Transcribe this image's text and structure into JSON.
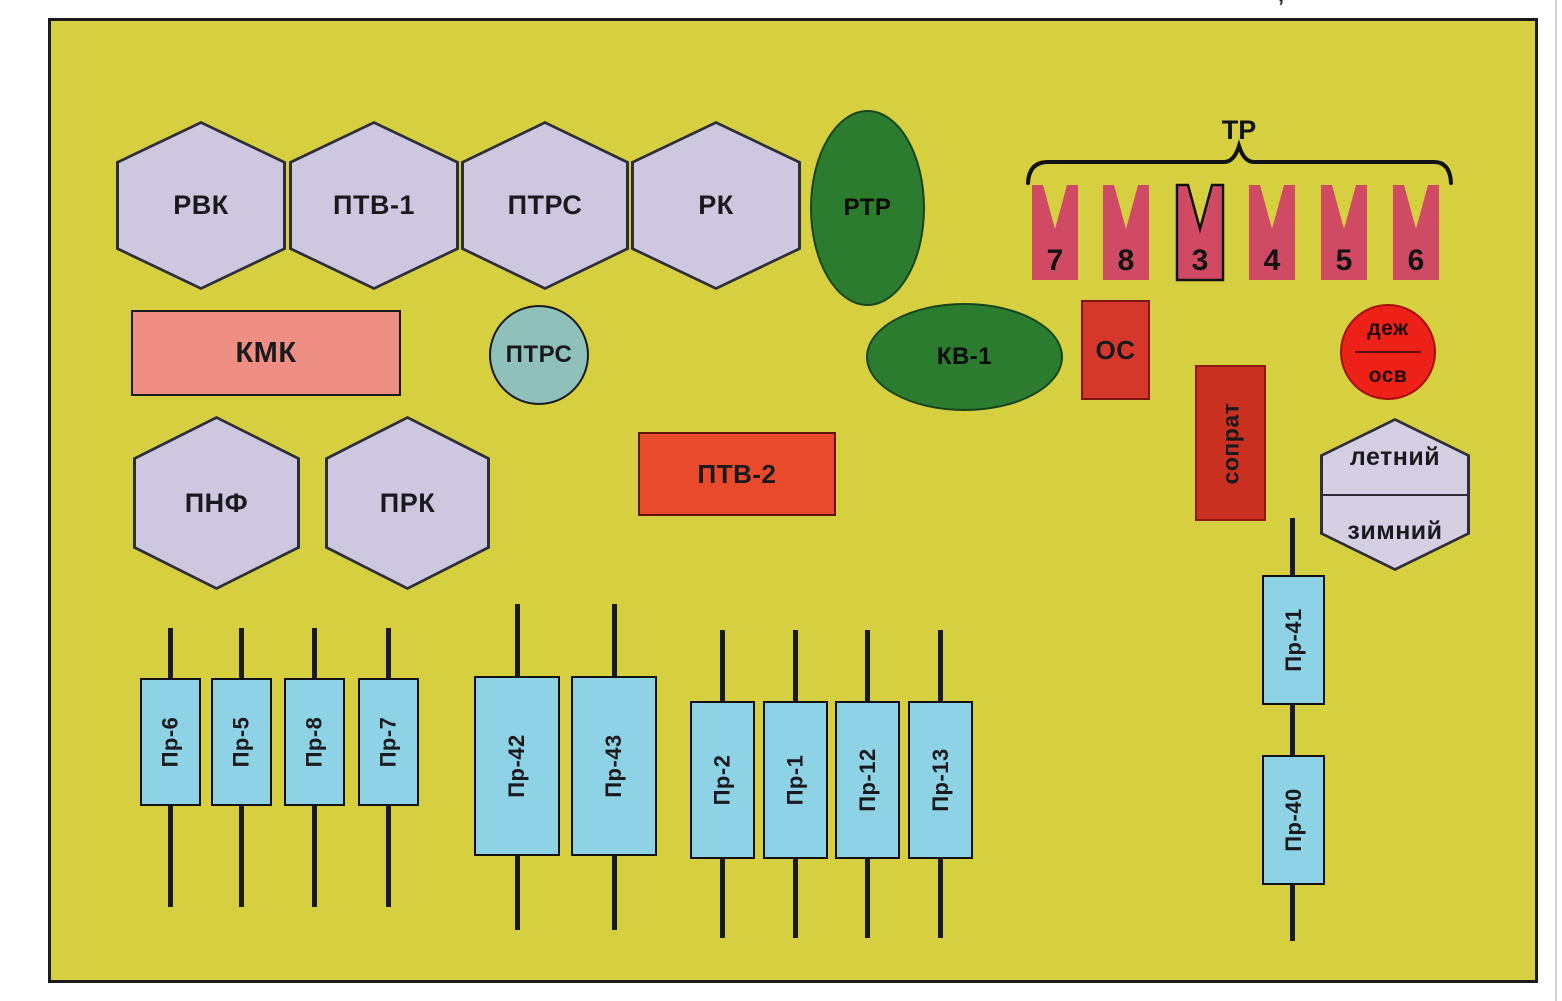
{
  "stray_mark": "’",
  "diagram": {
    "hexagons": {
      "rvk": "РВК",
      "ptv1": "ПТВ-1",
      "ptrs": "ПТРС",
      "rk": "РК",
      "pnf": "ПНФ",
      "prk": "ПРК"
    },
    "blocks": {
      "kmk": "КМК",
      "ptrs_circle": "ПТРС",
      "rtr": "РТР",
      "kv1": "КВ-1",
      "os": "ОС",
      "soprat": "сопрат",
      "ptv2": "ПТВ-2"
    },
    "tr_group": {
      "label": "ТР",
      "pennants": [
        "7",
        "8",
        "3",
        "4",
        "5",
        "6"
      ]
    },
    "dezh_osv": {
      "top": "деж",
      "bottom": "осв"
    },
    "season": {
      "top": "летний",
      "bottom": "зимний"
    },
    "fuses": {
      "row1": [
        "Пр-6",
        "Пр-5",
        "Пр-8",
        "Пр-7"
      ],
      "row2": [
        "Пр-42",
        "Пр-43"
      ],
      "row3": [
        "Пр-2",
        "Пр-1",
        "Пр-12",
        "Пр-13"
      ],
      "column": [
        "Пр-41",
        "Пр-40"
      ]
    },
    "colors": {
      "panel_bg": "#d6d041",
      "hexagon_fill": "#cec7e0",
      "kmk_fill": "#ef8e83",
      "ptrs_circle_fill": "#8fc0ba",
      "green_fill": "#2b7c2e",
      "os_fill": "#d5382b",
      "soprat_fill": "#c93020",
      "ptv2_fill": "#e84a2b",
      "pennant_fill": "#d04a63",
      "dezh_osv_fill": "#ee2118",
      "season_fill": "#d5cfe3",
      "fuse_fill": "#8ed2e5",
      "line_color": "#1a1a1a"
    }
  }
}
